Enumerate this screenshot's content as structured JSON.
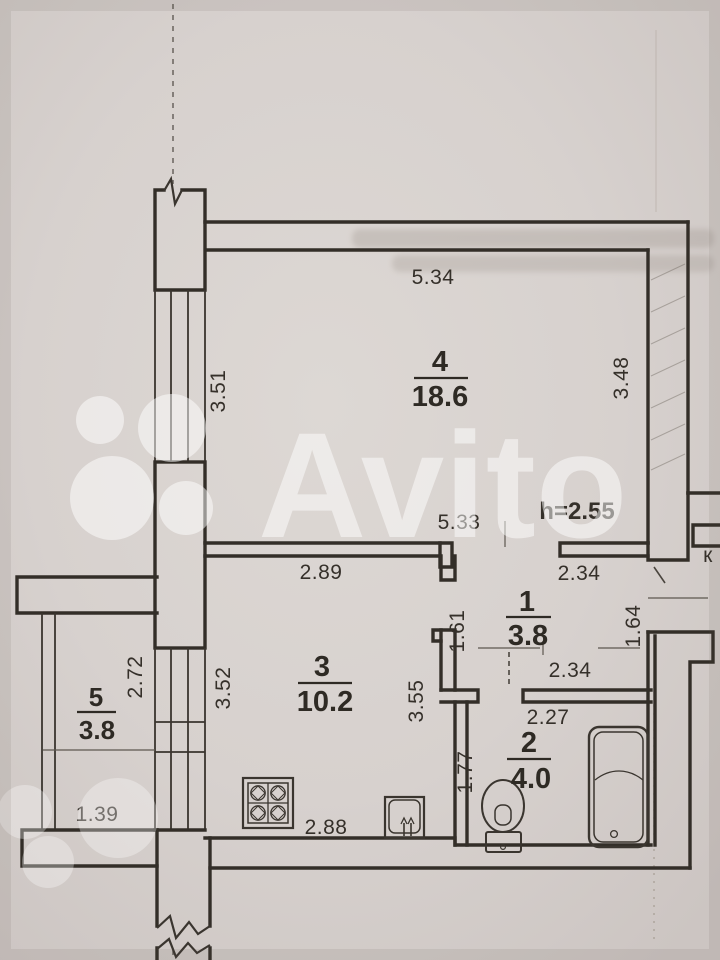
{
  "watermark": {
    "brand": "Avito"
  },
  "notes": {
    "ceiling_height": "h=2.55",
    "corridor_letter": "к"
  },
  "rooms": [
    {
      "number": "4",
      "area": "18.6"
    },
    {
      "number": "3",
      "area": "10.2"
    },
    {
      "number": "1",
      "area": "3.8"
    },
    {
      "number": "2",
      "area": "4.0"
    },
    {
      "number": "5",
      "area": "3.8"
    }
  ],
  "dimensions": {
    "room4_top": "5.34",
    "room4_left": "3.51",
    "room4_right": "3.48",
    "room4_bottom": "5.33",
    "hall_top": "2.34",
    "kitchen_top": "2.89",
    "hall_left": "1.61",
    "hall_right": "1.64",
    "hall_bottom": "2.34",
    "kitchen_left": "3.52",
    "kitchen_right": "3.55",
    "balcony_right": "2.72",
    "bath_top": "2.27",
    "bath_left": "1.77",
    "balcony_bottom": "1.39",
    "kitchen_bottom": "2.88"
  }
}
